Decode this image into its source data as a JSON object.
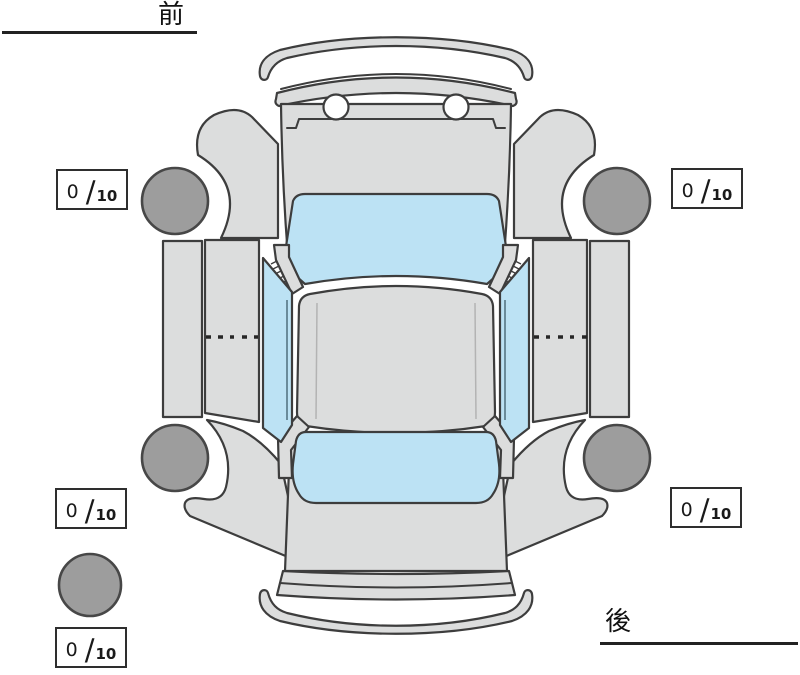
{
  "orientation": {
    "front_label": "前",
    "rear_label": "後"
  },
  "tread_readings": {
    "front_left": {
      "value": "0",
      "separator": "/",
      "max": "10"
    },
    "front_right": {
      "value": "0",
      "separator": "/",
      "max": "10"
    },
    "rear_left": {
      "value": "0",
      "separator": "/",
      "max": "10"
    },
    "rear_right": {
      "value": "0",
      "separator": "/",
      "max": "10"
    },
    "spare": {
      "value": "0",
      "separator": "/",
      "max": "10"
    }
  },
  "colors": {
    "background": "#ffffff",
    "body": "#dcdddd",
    "window": "#bce2f4",
    "tire": "#9d9d9d",
    "outline": "#3d3d3d"
  }
}
